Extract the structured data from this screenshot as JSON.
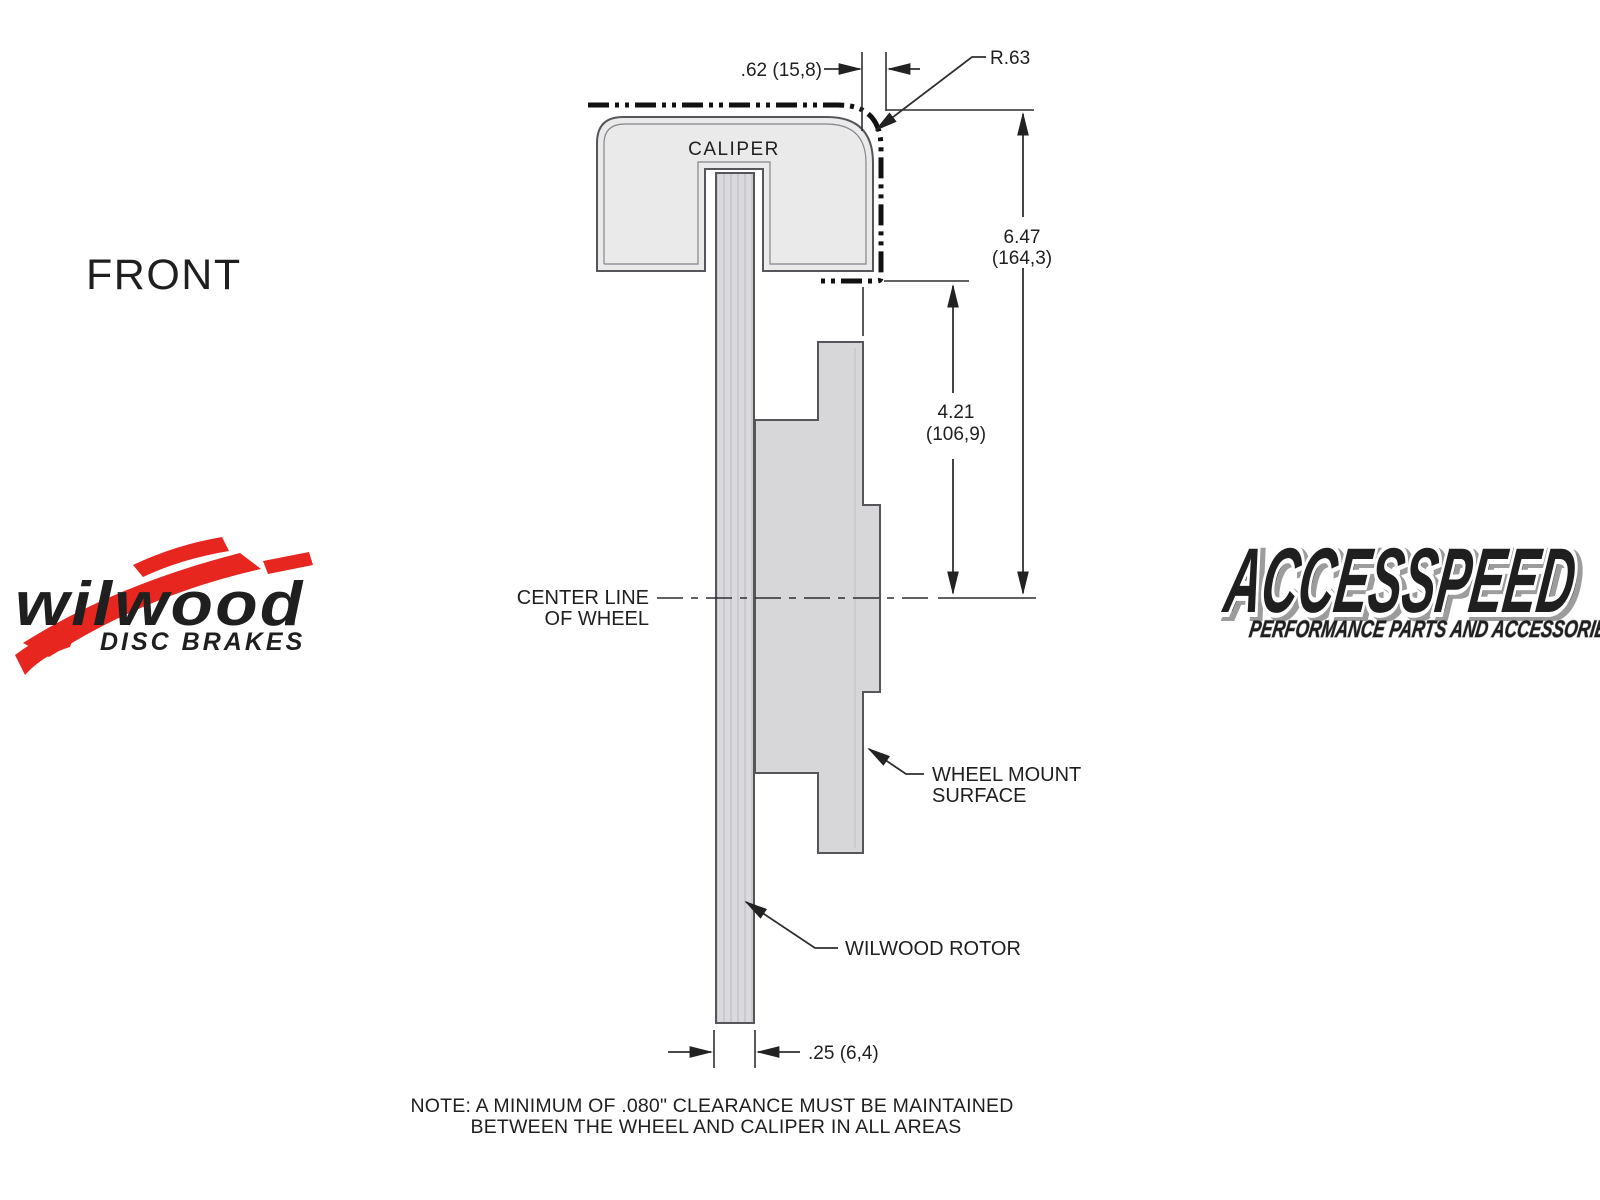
{
  "view_label": "FRONT",
  "diagram": {
    "caliper_label": "CALIPER",
    "center_line_label_1": "CENTER LINE",
    "center_line_label_2": "OF WHEEL",
    "wheel_mount_label_1": "WHEEL MOUNT",
    "wheel_mount_label_2": "SURFACE",
    "rotor_label": "WILWOOD ROTOR",
    "dim_offset": ".62 (15,8)",
    "dim_radius": "R.63",
    "dim_height_in": "6.47",
    "dim_height_mm": "(164,3)",
    "dim_mount_in": "4.21",
    "dim_mount_mm": "(106,9)",
    "dim_rotor_thickness": ".25 (6,4)"
  },
  "note_line_1": "NOTE: A MINIMUM OF .080\" CLEARANCE MUST BE MAINTAINED",
  "note_line_2": "BETWEEN THE WHEEL AND CALIPER IN ALL AREAS",
  "logo_wilwood": {
    "name": "wilwood",
    "tagline": "DISC BRAKES",
    "red": "#e6261f",
    "black": "#131313"
  },
  "logo_accesspeed": {
    "name": "ACCESSPEED",
    "tagline": "PERFORMANCE PARTS AND ACCESSORIES"
  },
  "colors": {
    "caliper_fill": "#eaeaeb",
    "rotor_fill": "#dadade",
    "line": "#2f2f2f"
  }
}
